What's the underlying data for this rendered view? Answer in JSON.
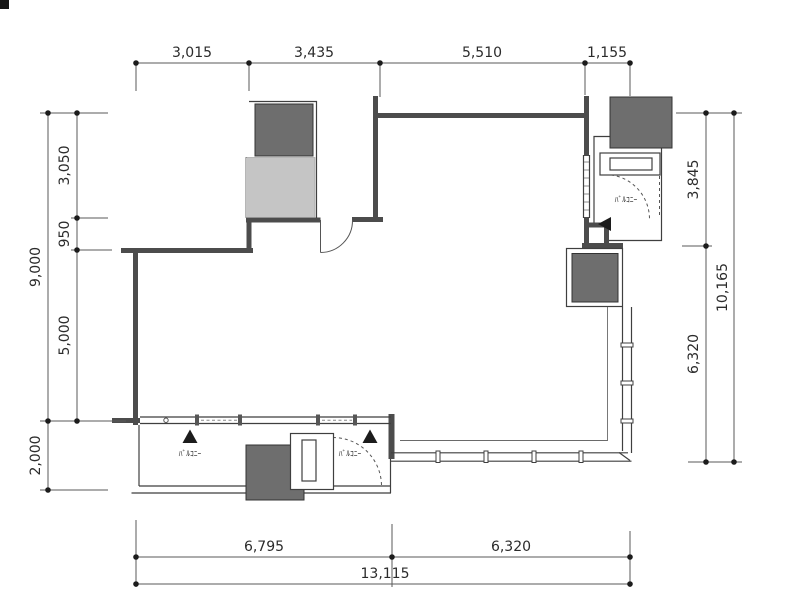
{
  "colors": {
    "background": "#ffffff",
    "wall": "#4c4c4c",
    "column_fill": "#6e6e6e",
    "shaft_fill": "#c5c5c5",
    "dim_line": "#5a5a5a",
    "dim_text": "#2b2b2b",
    "label_text": "#1c1c1c"
  },
  "dimensions": {
    "top": [
      "3,015",
      "3,435",
      "5,510",
      "1,155"
    ],
    "left_inner": [
      "3,050",
      "950",
      "5,000"
    ],
    "left_outer": [
      "9,000",
      "2,000"
    ],
    "right_inner": [
      "3,845",
      "6,320"
    ],
    "right_outer": [
      "10,165"
    ],
    "bottom_inner": [
      "6,795",
      "6,320"
    ],
    "bottom_outer": [
      "13,115"
    ]
  },
  "labels": {
    "balcony_left": "ﾊﾞﾙｺﾆｰ",
    "balcony_center": "ﾊﾞﾙｺﾆｰ",
    "balcony_right": "ﾊﾞﾙｺﾆｰ"
  }
}
